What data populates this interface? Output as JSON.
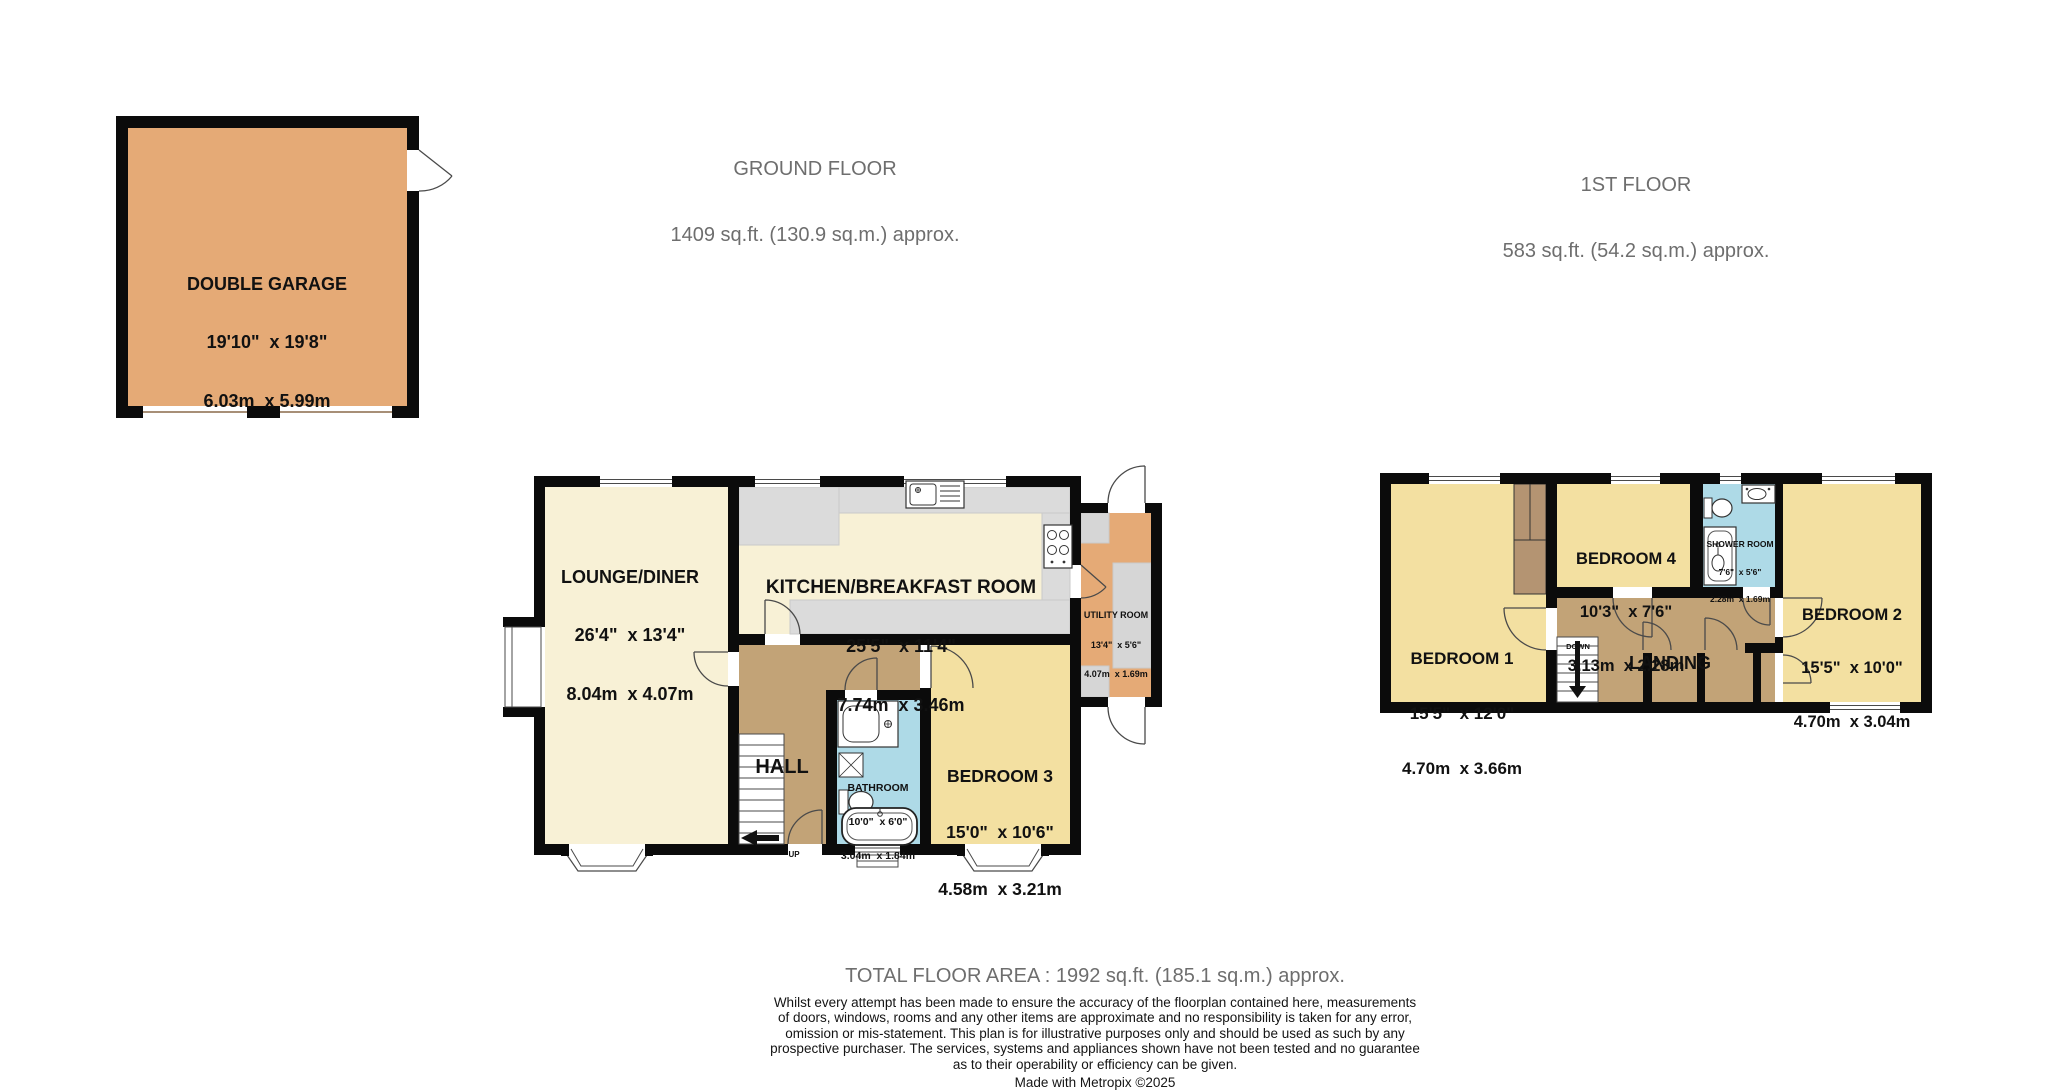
{
  "floors": {
    "ground": {
      "title": "GROUND FLOOR",
      "area": "1409 sq.ft. (130.9 sq.m.) approx."
    },
    "first": {
      "title": "1ST FLOOR",
      "area": "583 sq.ft. (54.2 sq.m.) approx."
    }
  },
  "rooms": {
    "garage": {
      "name": "DOUBLE GARAGE",
      "imperial": "19'10\"  x 19'8\"",
      "metric": "6.03m  x 5.99m"
    },
    "lounge": {
      "name": "LOUNGE/DINER",
      "imperial": "26'4\"  x 13'4\"",
      "metric": "8.04m  x 4.07m"
    },
    "kitchen": {
      "name": "KITCHEN/BREAKFAST ROOM",
      "imperial": "25'5\"  x 11'4\"",
      "metric": "7.74m  x 3.46m"
    },
    "utility": {
      "name": "UTILITY ROOM",
      "imperial": "13'4\"  x 5'6\"",
      "metric": "4.07m  x 1.69m"
    },
    "hall": {
      "name": "HALL"
    },
    "bathroom": {
      "name": "BATHROOM",
      "imperial": "10'0\"  x 6'0\"",
      "metric": "3.04m  x 1.84m"
    },
    "bedroom3": {
      "name": "BEDROOM 3",
      "imperial": "15'0\"  x 10'6\"",
      "metric": "4.58m  x 3.21m"
    },
    "bedroom1": {
      "name": "BEDROOM 1",
      "imperial": "15'5\"  x 12'0\"",
      "metric": "4.70m  x 3.66m"
    },
    "bedroom4": {
      "name": "BEDROOM 4",
      "imperial": "10'3\"  x 7'6\"",
      "metric": "3.13m  x 2.28m"
    },
    "shower": {
      "name": "SHOWER ROOM",
      "imperial": "7'6\"  x 5'6\"",
      "metric": "2.28m  x 1.69m"
    },
    "bedroom2": {
      "name": "BEDROOM 2",
      "imperial": "15'5\"  x 10'0\"",
      "metric": "4.70m  x 3.04m"
    },
    "landing": {
      "name": "LANDING"
    }
  },
  "stairs": {
    "up": "UP",
    "down": "DOWN"
  },
  "footer": {
    "total": "TOTAL FLOOR AREA : 1992 sq.ft. (185.1 sq.m.) approx.",
    "disclaimer_lines": [
      "Whilst every attempt has been made to ensure the accuracy of the floorplan contained here, measurements",
      "of doors, windows, rooms and any other items are approximate and no responsibility is taken for any error,",
      "omission or mis-statement. This plan is for illustrative purposes only and should be used as such by any",
      "prospective purchaser. The services, systems and appliances shown have not been tested and no guarantee",
      "as to their operability or efficiency can be given."
    ],
    "credit": "Made with Metropix ©2025"
  },
  "colors": {
    "garage_floor": "#E5AA76",
    "utility_floor": "#E5AA76",
    "living_floor": "#F8F1D6",
    "bedroom_floor": "#F3E0A1",
    "hall_floor": "#C2A377",
    "cupboard": "#B49472",
    "bathroom_floor": "#AEDAE7",
    "counter_gray": "#DBDBDB",
    "wall": "#0B0B0B",
    "header_text": "#6E6E6E"
  }
}
